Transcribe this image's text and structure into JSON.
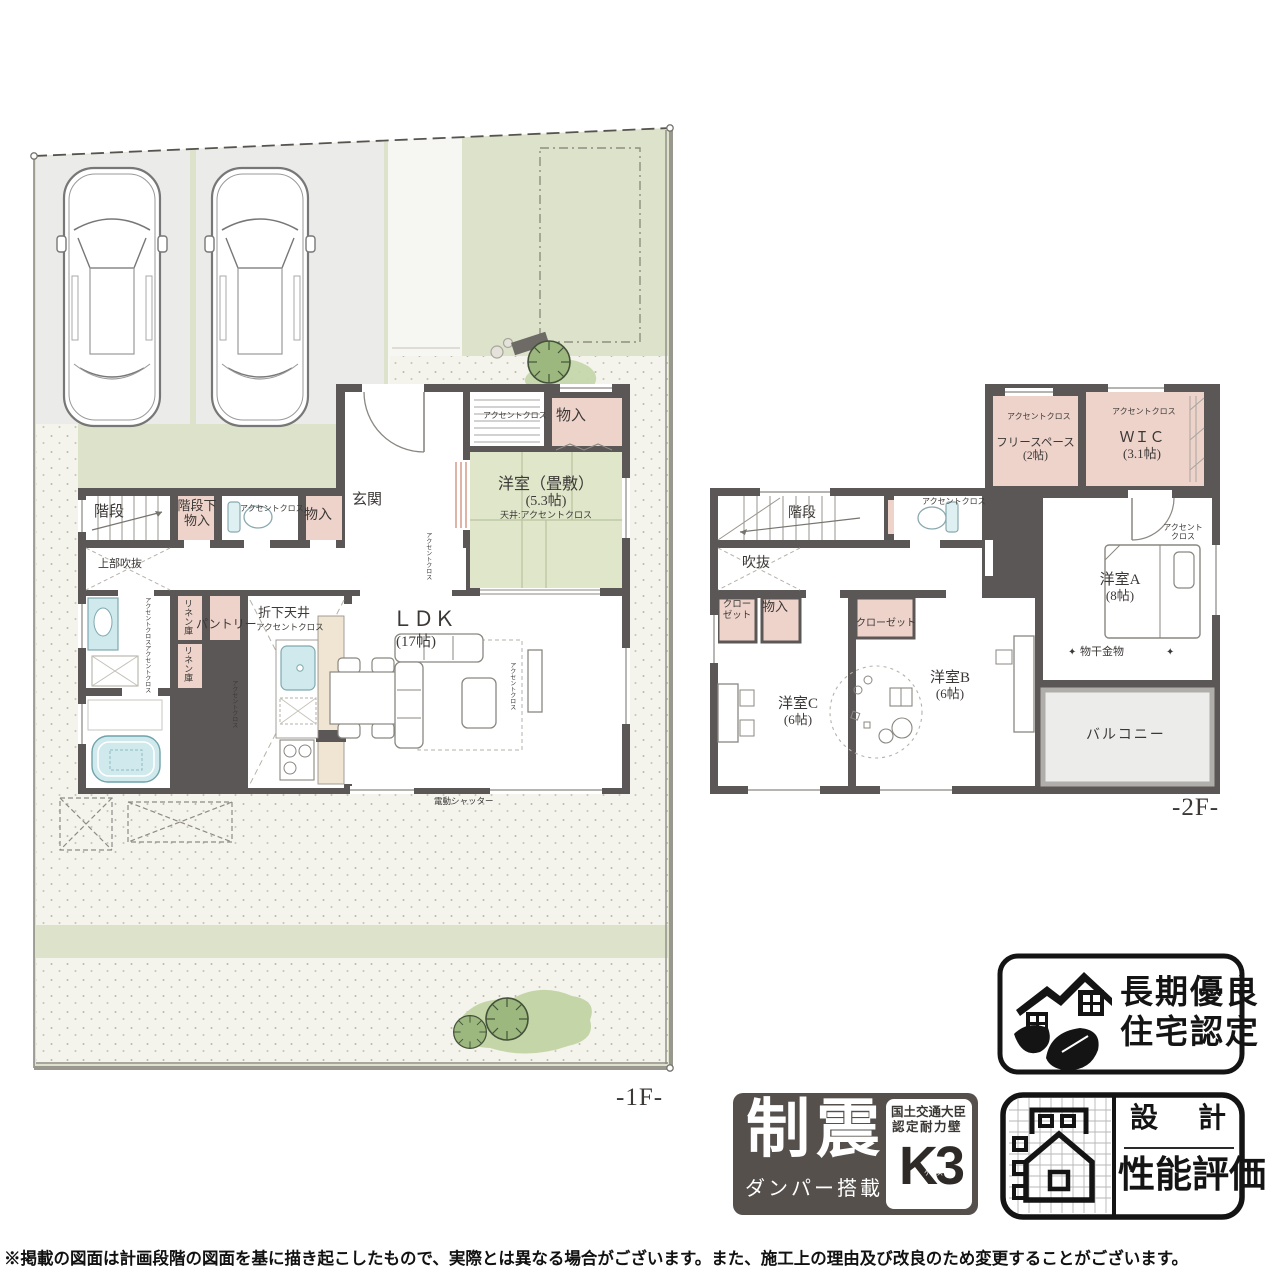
{
  "common": {
    "accent_cloth": "アクセントクロス",
    "storage": "物入",
    "stairs": "階段",
    "linen": "リネン庫"
  },
  "floor1": {
    "floor_label": "-1F-",
    "under_stairs_line1": "階段下",
    "under_stairs_line2": "物入",
    "entrance": "玄関",
    "tatami_room": "洋室（畳敷）",
    "tatami_size": "(5.3帖)",
    "tatami_ceiling": "天井:アクセントクロス",
    "upper_void": "上部吹抜",
    "pantry": "パントリー",
    "lowered_ceiling": "折下天井",
    "ldk": "ＬＤＫ",
    "ldk_size": "(17帖)",
    "electric_shutter": "電動シャッター"
  },
  "floor2": {
    "floor_label": "-2F-",
    "free_space": "フリースペース",
    "free_space_size": "(2帖)",
    "wic": "ＷＩＣ",
    "wic_size": "(3.1帖)",
    "void": "吹抜",
    "closet_line1": "クロー",
    "closet_line2": "ゼット",
    "closet": "クローゼット",
    "room_a": "洋室A",
    "room_a_size": "(8帖)",
    "accent_line1": "アクセント",
    "accent_line2": "クロス",
    "drying_fixture": "物干金物",
    "diamond": "✦",
    "room_b": "洋室B",
    "room_b_size": "(6帖)",
    "room_c": "洋室C",
    "room_c_size": "(6帖)",
    "balcony": "バルコニー"
  },
  "badges": {
    "longterm_line1": "長期優良",
    "longterm_line2": "住宅認定",
    "seismic_big": "制震",
    "seismic_sub": "ダンパー搭載",
    "minister_line1": "国土交通大臣",
    "minister_line2": "認定耐力壁",
    "k3": "K3",
    "k3_sub": "ケースリー",
    "design_top": "設　計",
    "design_bottom": "性能評価"
  },
  "footer": {
    "disclaimer": "※掲載の図面は計画段階の図面を基に描き起こしたもので、実際とは異なる場合がございます。また、施工上の理由及び改良のため変更することがございます。"
  },
  "colors": {
    "wall": "#5b5756",
    "lawn": "#dde3cb",
    "tatami": "#dfe6c9",
    "closet_pink": "#eed3cb",
    "fixture_blue": "#cfe9ec",
    "paving": "#f4f3ec",
    "counter": "#f0e4d2",
    "badge_dark": "#56504d"
  }
}
